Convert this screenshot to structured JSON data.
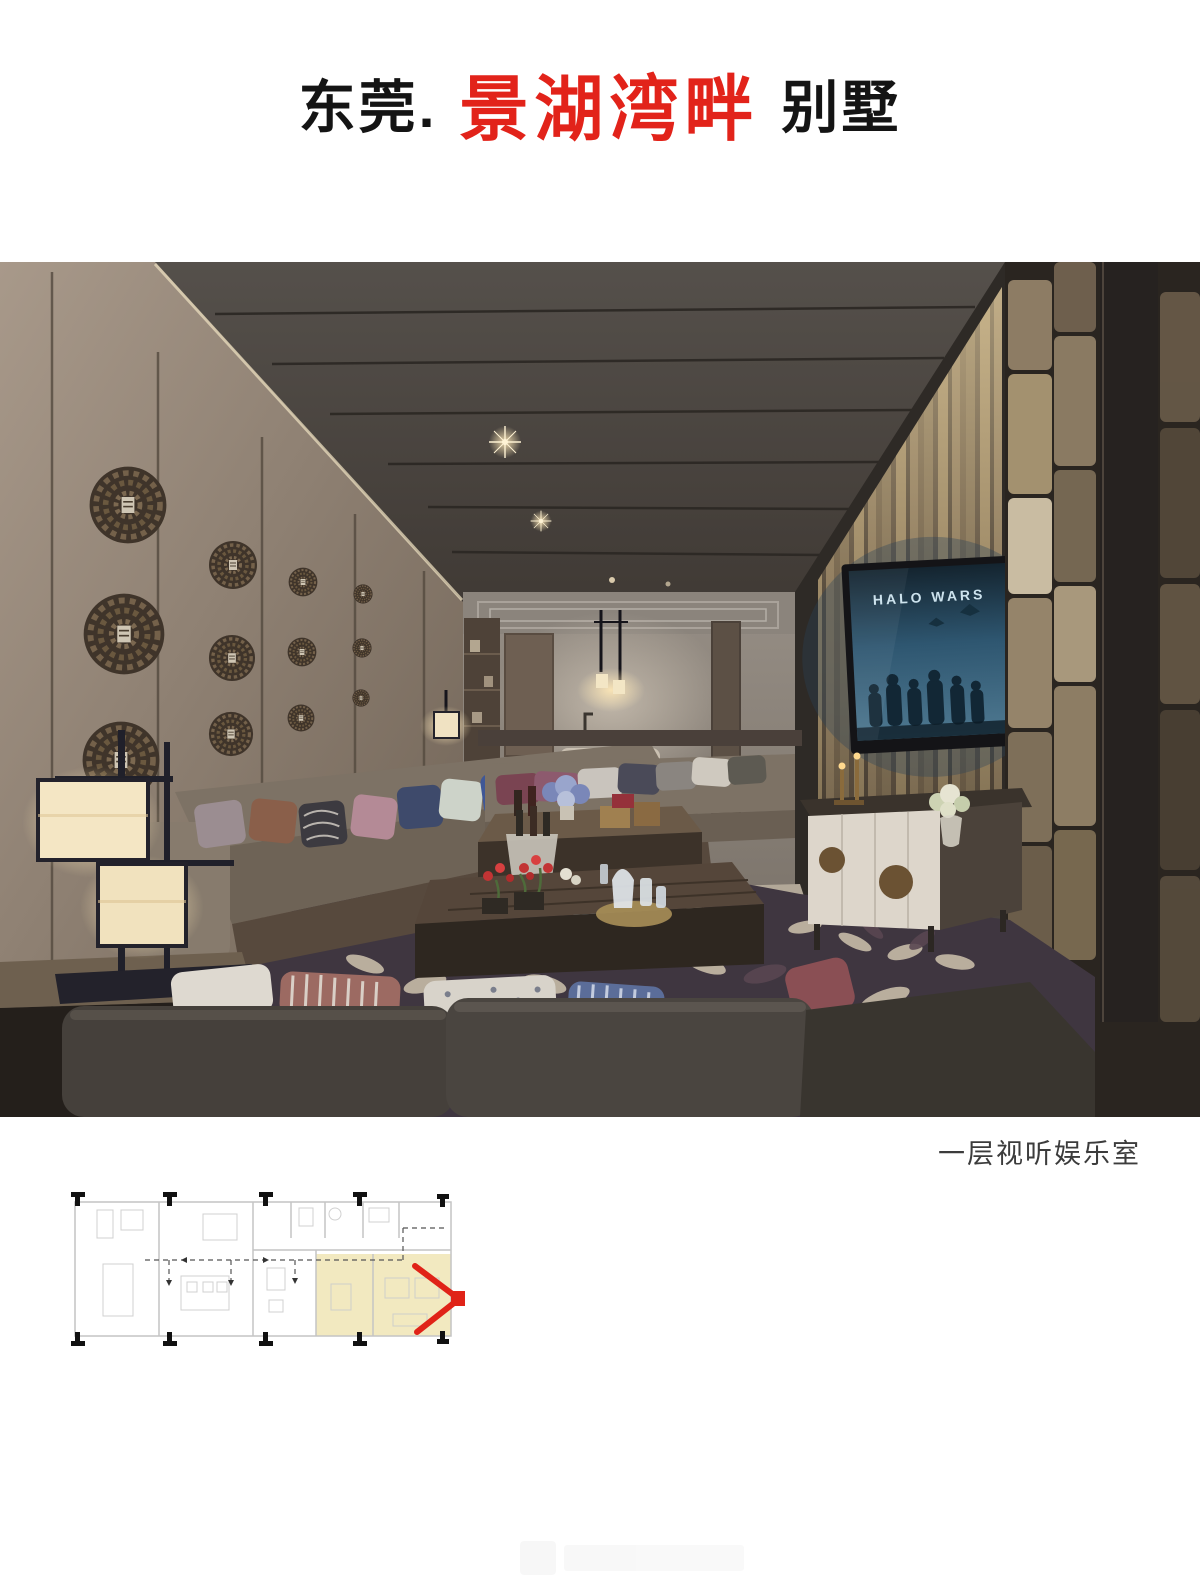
{
  "page": {
    "background": "#ffffff"
  },
  "header": {
    "city": "东莞.",
    "project": "景湖湾畔",
    "type": "别墅",
    "project_color": "#e2231a"
  },
  "photo": {
    "caption": "一层视听娱乐室",
    "tv_title": "HALO WARS",
    "tv_screen_color": "#2e5670"
  },
  "floor_plan": {
    "highlight_color": "#f2e9c0",
    "arrow_color": "#e02318"
  }
}
